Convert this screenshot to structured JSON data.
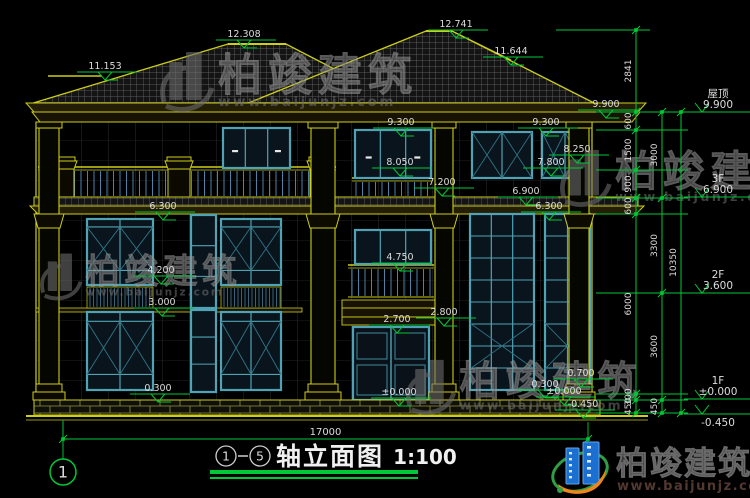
{
  "colors": {
    "line_yellow": "#CDCD1A",
    "dim_green": "#00C837",
    "text_white": "#DCDCDC",
    "window_frame": "#4FA3B5",
    "window_mullion": "#2E7486",
    "pane": "#0A141C",
    "railing": "#4E82A8",
    "watermark_gray": "#6E6E6E",
    "brand_blue": "#1B6FD0",
    "brand_orange": "#F08519",
    "brand_green": "#2F9E44",
    "brand_text": "#3A3A3A",
    "brand_url": "#52382F"
  },
  "drawing": {
    "levels": [
      {
        "value": "11.153",
        "x": 105,
        "y": 72
      },
      {
        "value": "12.308",
        "x": 244,
        "y": 40
      },
      {
        "value": "12.741",
        "x": 456,
        "y": 30
      },
      {
        "value": "11.644",
        "x": 511,
        "y": 57
      },
      {
        "value": "9.900",
        "x": 606,
        "y": 110
      },
      {
        "value": "9.300",
        "x": 401,
        "y": 128
      },
      {
        "value": "9.300",
        "x": 546,
        "y": 128
      },
      {
        "value": "8.050",
        "x": 400,
        "y": 168
      },
      {
        "value": "8.250",
        "x": 577,
        "y": 155
      },
      {
        "value": "7.800",
        "x": 551,
        "y": 168
      },
      {
        "value": "7.200",
        "x": 442,
        "y": 188
      },
      {
        "value": "6.900",
        "x": 526,
        "y": 197
      },
      {
        "value": "6.300",
        "x": 163,
        "y": 212
      },
      {
        "value": "6.300",
        "x": 549,
        "y": 212
      },
      {
        "value": "4.750",
        "x": 400,
        "y": 263
      },
      {
        "value": "4.200",
        "x": 161,
        "y": 276
      },
      {
        "value": "3.000",
        "x": 162,
        "y": 308
      },
      {
        "value": "2.700",
        "x": 397,
        "y": 325
      },
      {
        "value": "2.800",
        "x": 444,
        "y": 318
      },
      {
        "value": "0.300",
        "x": 158,
        "y": 394
      },
      {
        "value": "0.300",
        "x": 545,
        "y": 390
      },
      {
        "value": "0.700",
        "x": 581,
        "y": 379
      },
      {
        "value": "±0.000",
        "x": 399,
        "y": 398
      },
      {
        "value": "±0.000",
        "x": 564,
        "y": 397
      },
      {
        "value": "-0.450",
        "x": 583,
        "y": 410
      }
    ],
    "floor_marks": [
      {
        "label": "屋顶",
        "value": "9.900",
        "y": 112,
        "text_below": false
      },
      {
        "label": "3F",
        "value": "6.900",
        "y": 197,
        "text_below": false
      },
      {
        "label": "2F",
        "value": "3.600",
        "y": 293,
        "text_below": false
      },
      {
        "label": "1F",
        "value": "±0.000",
        "y": 399,
        "text_below": false
      },
      {
        "label": "",
        "value": "-0.450",
        "y": 414,
        "text_below": true
      }
    ],
    "dim_chains": [
      {
        "x": 636,
        "boundaries": [
          30,
          112,
          130,
          170,
          198,
          214,
          394,
          400,
          413
        ],
        "labels": [
          "2841",
          "600",
          "1500",
          "900",
          "600",
          "6000",
          "300",
          "450"
        ]
      },
      {
        "x": 662,
        "boundaries": [
          112,
          198,
          293,
          400,
          413
        ],
        "labels": [
          "3000",
          "3300",
          "3600",
          "450"
        ]
      },
      {
        "x": 681,
        "boundaries": [
          112,
          413
        ],
        "labels": [
          "10350"
        ]
      }
    ],
    "bottom_dim": {
      "value": "17000",
      "x1": 63,
      "x2": 588,
      "y": 439
    },
    "axis_bubble": {
      "label": "1",
      "x": 63,
      "y": 472
    },
    "title": {
      "from": "1",
      "to": "5",
      "name": "轴立面图",
      "scale": "1:100"
    }
  },
  "watermark": {
    "brand": "柏竣建筑",
    "url": "www.baijunjz.com",
    "instances": [
      {
        "x": 160,
        "y": 50,
        "s": 1.0
      },
      {
        "x": 560,
        "y": 148,
        "s": 0.95
      },
      {
        "x": 40,
        "y": 252,
        "s": 0.78
      },
      {
        "x": 406,
        "y": 358,
        "s": 0.92
      }
    ]
  },
  "footer_brand": {
    "name": "柏竣建筑",
    "url": "www.baijunjz.com"
  }
}
